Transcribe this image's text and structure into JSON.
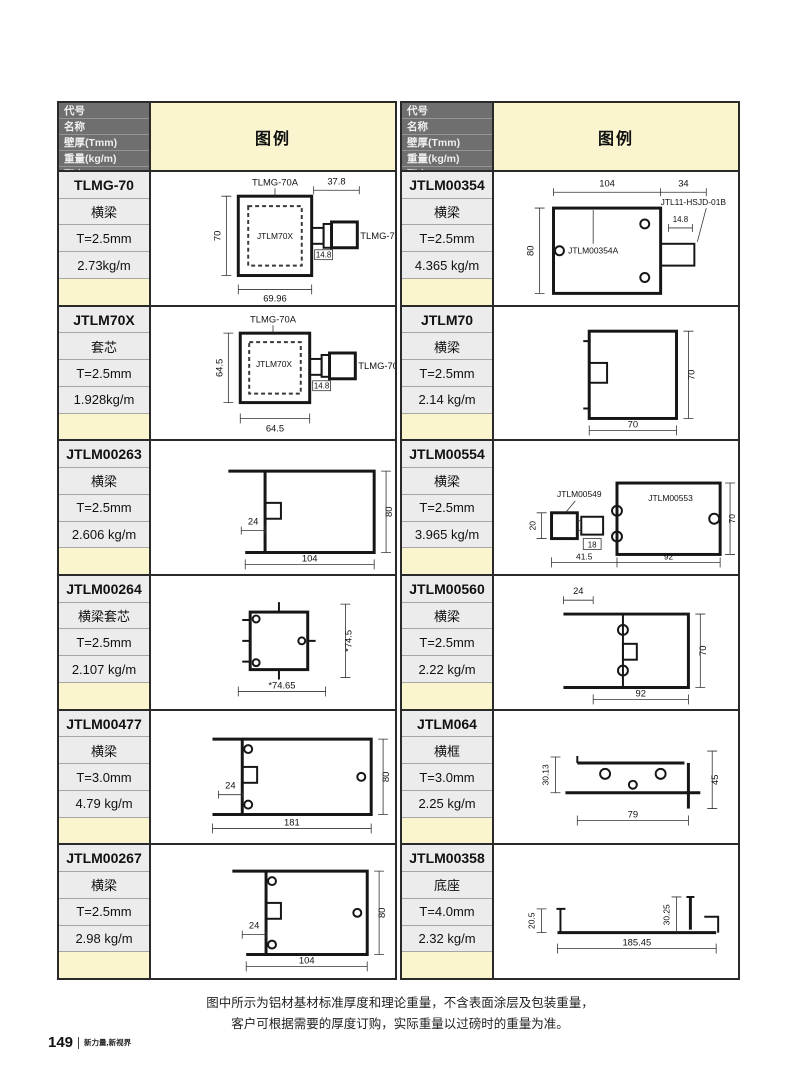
{
  "header": {
    "rows": [
      "代号",
      "名称",
      "壁厚(Tmm)",
      "重量(kg/m)",
      "配套"
    ],
    "legend": "图例"
  },
  "left": {
    "blocks": [
      {
        "code": "TLMG-70",
        "name": "横梁",
        "thickness": "T=2.5mm",
        "weight": "2.73kg/m",
        "fig": {
          "top_label": "TLMG-70A",
          "inner_label": "JTLM70X",
          "right_label": "TLMG-70B",
          "dim_top": "37.8",
          "dim_left": "70",
          "dim_conn": "14.8",
          "dim_bottom": "69.96"
        }
      },
      {
        "code": "JTLM70X",
        "name": "套芯",
        "thickness": "T=2.5mm",
        "weight": "1.928kg/m",
        "fig": {
          "top_label": "TLMG-70A",
          "inner_label": "JTLM70X",
          "right_label": "TLMG-70B",
          "dim_left": "64.5",
          "dim_conn": "14.8",
          "dim_bottom": "64.5"
        }
      },
      {
        "code": "JTLM00263",
        "name": "横梁",
        "thickness": "T=2.5mm",
        "weight": "2.606 kg/m",
        "fig": {
          "dim_notch": "24",
          "dim_right": "80",
          "dim_bottom": "104"
        }
      },
      {
        "code": "JTLM00264",
        "name": "横梁套芯",
        "thickness": "T=2.5mm",
        "weight": "2.107 kg/m",
        "fig": {
          "dim_right": "*74.5",
          "dim_bottom": "*74.65"
        }
      },
      {
        "code": "JTLM00477",
        "name": "横梁",
        "thickness": "T=3.0mm",
        "weight": "4.79 kg/m",
        "fig": {
          "dim_notch": "24",
          "dim_right": "80",
          "dim_bottom": "181"
        }
      },
      {
        "code": "JTLM00267",
        "name": "横梁",
        "thickness": "T=2.5mm",
        "weight": "2.98 kg/m",
        "fig": {
          "dim_notch": "24",
          "dim_right": "80",
          "dim_bottom": "104"
        }
      }
    ]
  },
  "right": {
    "blocks": [
      {
        "code": "JTLM00354",
        "name": "横梁",
        "thickness": "T=2.5mm",
        "weight": "4.365 kg/m",
        "fig": {
          "dim_w1": "104",
          "dim_w2": "34",
          "right_label": "JTL11-HSJD-01B",
          "dim_conn": "14.8",
          "inner_label": "JTLM00354A",
          "dim_left": "80"
        }
      },
      {
        "code": "JTLM70",
        "name": "横梁",
        "thickness": "T=2.5mm",
        "weight": "2.14 kg/m",
        "fig": {
          "dim_right": "70",
          "dim_bottom": "70"
        }
      },
      {
        "code": "JTLM00554",
        "name": "横梁",
        "thickness": "T=2.5mm",
        "weight": "3.965 kg/m",
        "fig": {
          "left_label": "JTLM00549",
          "main_label": "JTLM00553",
          "dim_left": "20",
          "dim_conn": "18",
          "dim_b1": "41.5",
          "dim_b2": "92",
          "dim_right": "70"
        }
      },
      {
        "code": "JTLM00560",
        "name": "横梁",
        "thickness": "T=2.5mm",
        "weight": "2.22 kg/m",
        "fig": {
          "dim_top": "24",
          "dim_right": "70",
          "dim_bottom": "92"
        }
      },
      {
        "code": "JTLM064",
        "name": "横框",
        "thickness": "T=3.0mm",
        "weight": "2.25 kg/m",
        "fig": {
          "dim_left": "30.13",
          "dim_right": "45",
          "dim_bottom": "79"
        }
      },
      {
        "code": "JTLM00358",
        "name": "底座",
        "thickness": "T=4.0mm",
        "weight": "2.32 kg/m",
        "fig": {
          "dim_left": "20.5",
          "dim_mid": "30.25",
          "dim_bottom": "185.45"
        }
      }
    ]
  },
  "note": {
    "line1": "图中所示为铝材基材标准厚度和理论重量，不含表面涂层及包装重量，",
    "line2": "客户可根据需要的厚度订购，实际重量以过磅时的重量为准。"
  },
  "footer": {
    "page": "149",
    "brand": "新力量,新视界"
  },
  "colors": {
    "legend_bg": "#FAF4CF",
    "header_bg": "#6F6F6F",
    "cell_bg": "#ECECEC",
    "line": "#2A2A2A"
  }
}
